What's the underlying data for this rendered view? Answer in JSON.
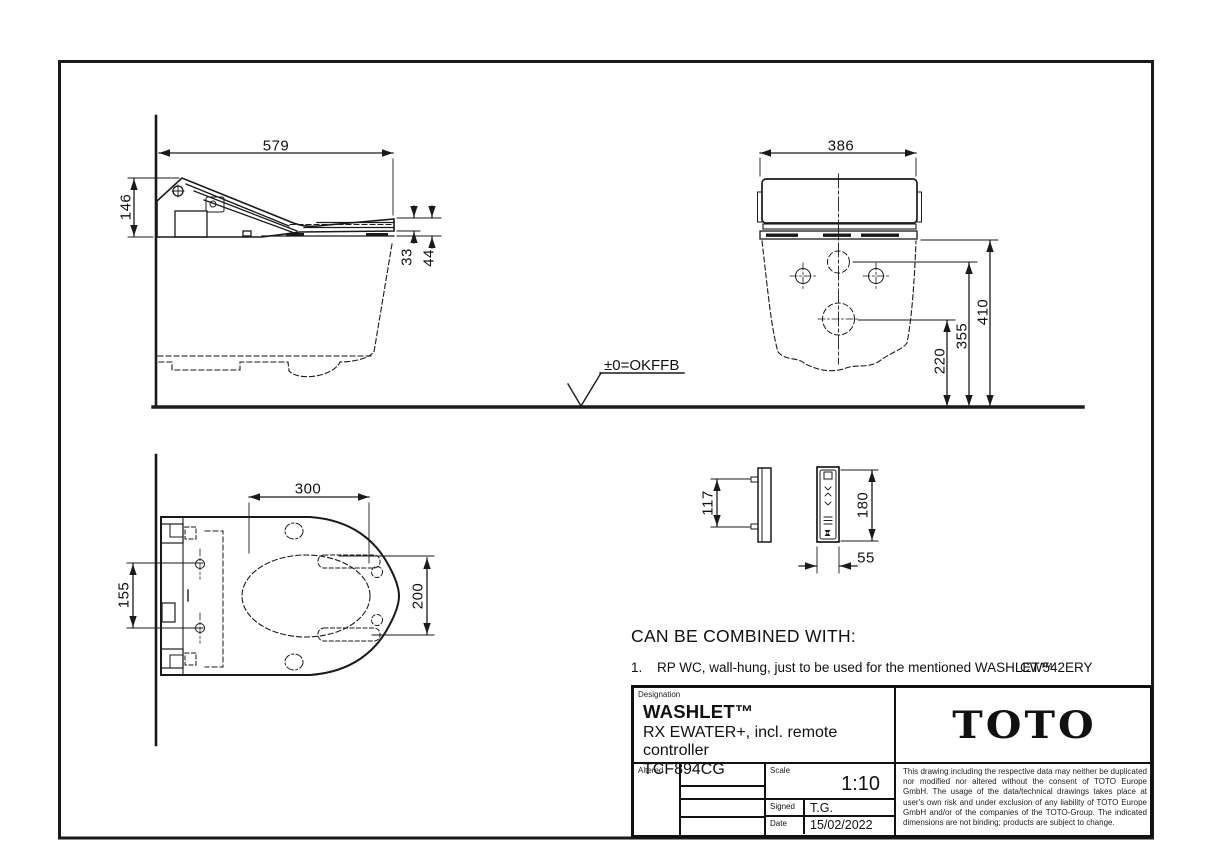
{
  "drawing": {
    "side_view": {
      "width_mm": "579",
      "height_mm": "146",
      "seat_thickness_mm": "33",
      "seat_base_mm": "44"
    },
    "front_view": {
      "width_mm": "386",
      "height_top_mm": "410",
      "height_upper_hole_mm": "355",
      "height_lower_hole_mm": "220"
    },
    "top_view": {
      "depth_mm": "300",
      "opening_mm": "200",
      "hole_pitch_mm": "155"
    },
    "remote_side_view": {
      "pin_pitch_mm": "117"
    },
    "remote_front_view": {
      "height_mm": "180",
      "width_mm": "55"
    },
    "floor_level_label": "±0=OKFFB"
  },
  "combined_with": {
    "heading": "CAN BE COMBINED WITH:",
    "item_no": "1.",
    "item_text": "RP WC, wall-hung, just to be used for the mentioned WASHLET™",
    "item_code": "CW542ERY"
  },
  "title_block": {
    "designation_label": "Designation",
    "product_name": "WASHLET™",
    "product_desc": "RX EWATER+, incl. remote controller",
    "product_code": "TCF894CG",
    "brand": "TOTO",
    "altered_label": "Altered",
    "scale_label": "Scale",
    "scale_value": "1:10",
    "signed_label": "Signed",
    "signed_value": "T.G.",
    "date_label": "Date",
    "date_value": "15/02/2022",
    "disclaimer": "This drawing including the respective data may neither be duplicated nor modified nor altered without the consent of TOTO Europe GmbH. The usage of the data/technical drawings takes place at user's own risk and under exclusion of any liability of TOTO Europe GmbH and/or of the companies of the TOTO-Group. The indicated dimensions are not binding; products are subject to change."
  },
  "colors": {
    "line": "#1a1a1a",
    "background": "#ffffff"
  }
}
